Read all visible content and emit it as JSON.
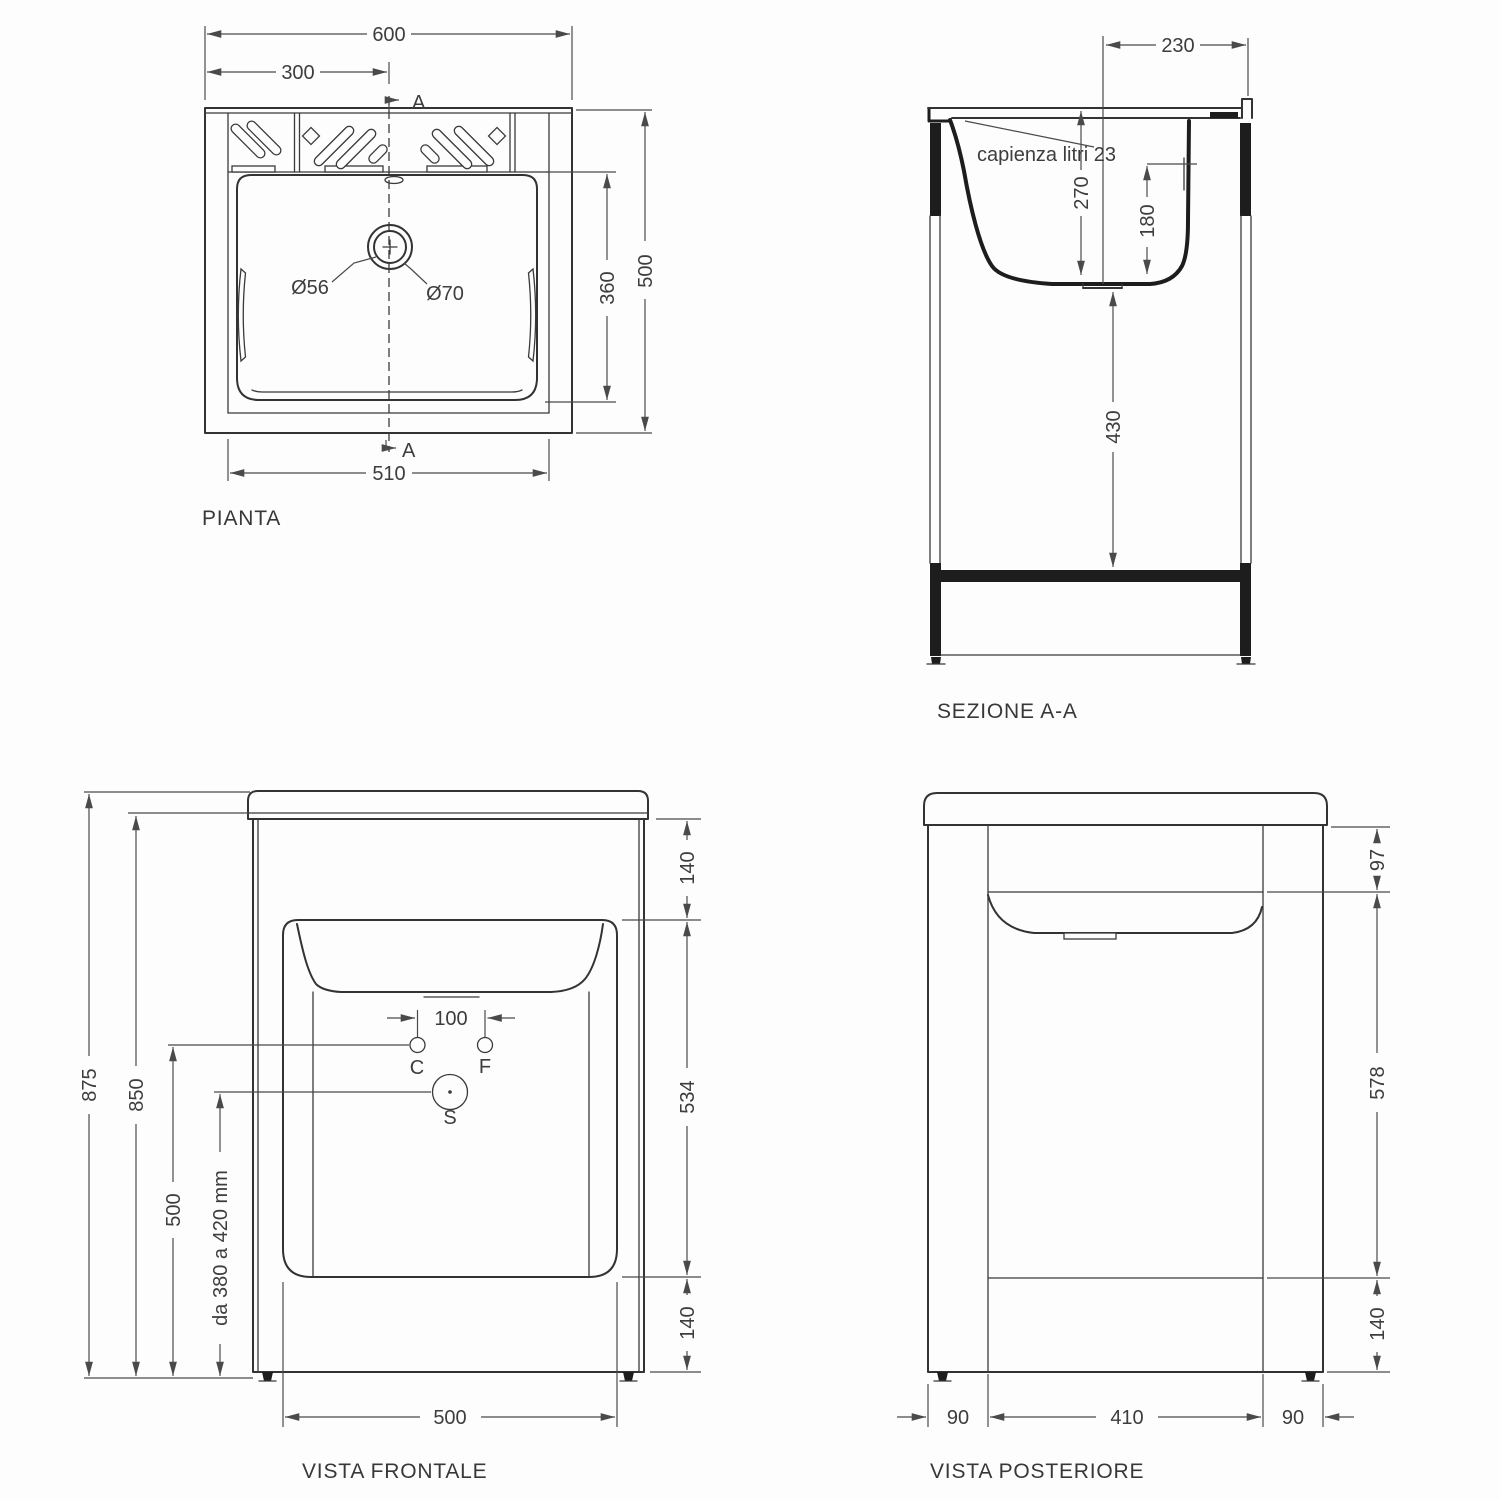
{
  "drawing": {
    "pianta": {
      "title": "PIANTA",
      "dim_width": "600",
      "dim_half": "300",
      "dim_inner_width": "510",
      "dim_depth": "500",
      "dim_basin_depth": "360",
      "drain_small": "Ø56",
      "drain_large": "Ø70",
      "section_letter_top": "A",
      "section_letter_bottom": "A"
    },
    "sezione": {
      "title": "SEZIONE A-A",
      "capacity_note": "capienza litri 23",
      "dim_back_offset": "230",
      "dim_basin_depth": "270",
      "dim_drain_height": "180",
      "dim_under_height": "430"
    },
    "frontale": {
      "title": "VISTA FRONTALE",
      "dim_total_height": "875",
      "dim_top_height": "850",
      "dim_drain_line": "500",
      "dim_trap_note": "da 380 a 420 mm",
      "dim_tap_spacing": "100",
      "dim_top": "140",
      "dim_panel": "534",
      "dim_bottom": "140",
      "dim_width": "500",
      "hole_c": "C",
      "hole_f": "F",
      "hole_s": "S"
    },
    "posteriore": {
      "title": "VISTA POSTERIORE",
      "dim_top": "97",
      "dim_panel": "578",
      "dim_bottom": "140",
      "dim_left": "90",
      "dim_center": "410",
      "dim_right": "90"
    }
  }
}
